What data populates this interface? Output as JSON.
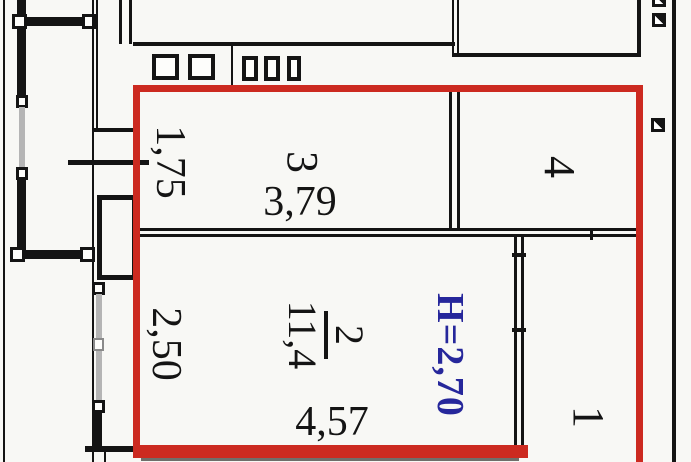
{
  "title": "apartment-floor-plan",
  "colors": {
    "outline_red": "#cc2a20",
    "height_text_blue": "#26279b",
    "wall_black": "#141414",
    "window_grey": "#b5b5b5"
  },
  "rooms": {
    "room3": {
      "number": "3",
      "width": "3,79",
      "side_dim": "1,75"
    },
    "room4": {
      "number": "4"
    },
    "room2": {
      "number": "2",
      "area": "11,4",
      "width": "4,57",
      "side_dim": "2,50"
    },
    "room1": {
      "number": "1"
    }
  },
  "annotations": {
    "ceiling_height": "Н=2,70"
  }
}
